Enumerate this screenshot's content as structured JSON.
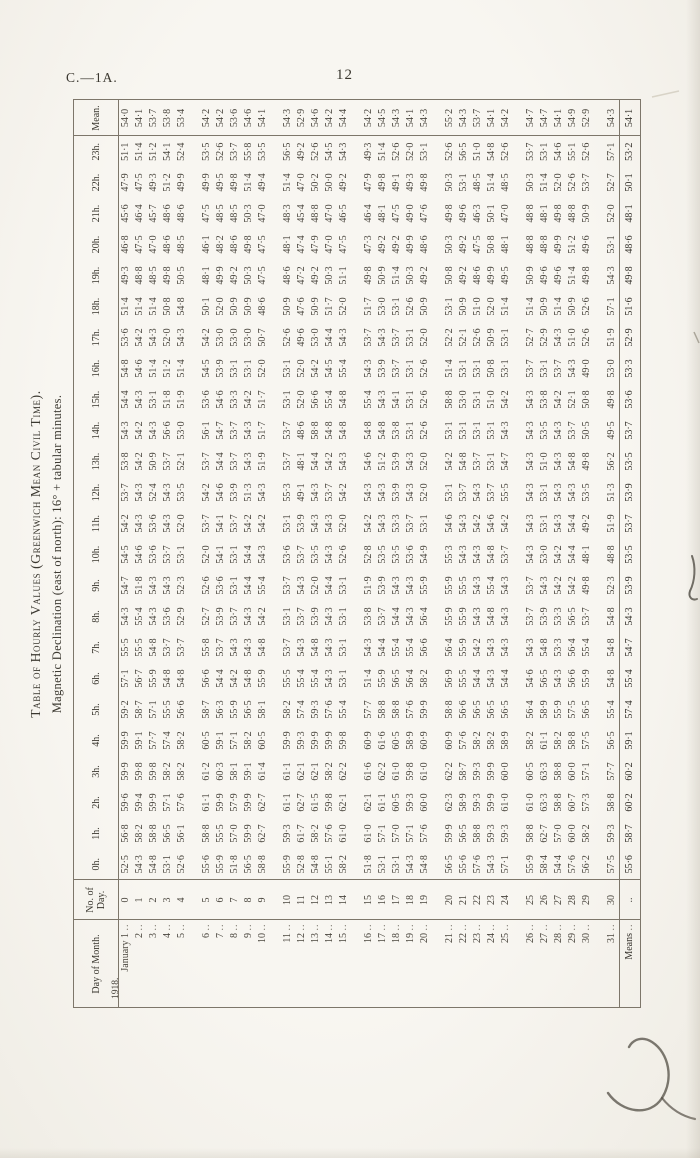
{
  "page": {
    "doc_ref": "C.—1A.",
    "page_number": "12"
  },
  "table": {
    "title": "Table of Hourly Values (Greenwich Mean Civil Time).",
    "subtitle": "Magnetic Declination (east of north): 16° + tabular minutes.",
    "year_label": "1918.",
    "means_label": "Means",
    "leader_dots": "..",
    "columns": [
      "Day of Month.",
      "No. of Day.",
      "0h.",
      "1h.",
      "2h.",
      "3h.",
      "4h.",
      "5h.",
      "6h.",
      "7h.",
      "8h.",
      "9h.",
      "10h.",
      "11h.",
      "12h.",
      "13h.",
      "14h.",
      "15h.",
      "16h.",
      "17h.",
      "18h.",
      "19h.",
      "20h.",
      "21h.",
      "22h.",
      "23h.",
      "Mean."
    ],
    "day_labels": [
      "January 1",
      "2",
      "3",
      "4",
      "5",
      "6",
      "7",
      "8",
      "9",
      "10",
      "11",
      "12",
      "13",
      "14",
      "15",
      "16",
      "17",
      "18",
      "19",
      "20",
      "21",
      "22",
      "23",
      "24",
      "25",
      "26",
      "27",
      "28",
      "29",
      "30",
      "31"
    ],
    "no_of_day": [
      "0",
      "1",
      "2",
      "3",
      "4",
      "5",
      "6",
      "7",
      "8",
      "9",
      "10",
      "11",
      "12",
      "13",
      "14",
      "15",
      "16",
      "17",
      "18",
      "19",
      "20",
      "21",
      "22",
      "23",
      "24",
      "25",
      "26",
      "27",
      "28",
      "29",
      "30"
    ],
    "hours": [
      {
        "label": "0h.",
        "values": [
          "52·5",
          "54·3",
          "54·8",
          "53·1",
          "52·6",
          "55·6",
          "55·9",
          "51·8",
          "56·5",
          "58·8",
          "55·9",
          "52·8",
          "54·8",
          "55·1",
          "58·2",
          "51·8",
          "53·1",
          "53·1",
          "54·3",
          "54·8",
          "56·5",
          "55·6",
          "57·6",
          "54·3",
          "57·1",
          "55·9",
          "58·4",
          "54·4",
          "57·6",
          "56·2",
          "57·5",
          "55·6"
        ]
      },
      {
        "label": "1h.",
        "values": [
          "56·8",
          "58·2",
          "58·8",
          "56·5",
          "56·1",
          "58·8",
          "55·5",
          "57·0",
          "59·9",
          "62·7",
          "59·3",
          "61·7",
          "58·2",
          "57·6",
          "61·0",
          "61·0",
          "57·1",
          "57·0",
          "57·1",
          "57·6",
          "59·9",
          "56·5",
          "58·8",
          "59·3",
          "59·3",
          "58·8",
          "62·7",
          "57·0",
          "60·0",
          "58·2",
          "59·3",
          "58·7"
        ]
      },
      {
        "label": "2h.",
        "values": [
          "59·6",
          "59·4",
          "59·9",
          "57·1",
          "57·6",
          "61·1",
          "59·9",
          "57·9",
          "59·9",
          "62·7",
          "61·1",
          "62·7",
          "61·5",
          "59·8",
          "62·1",
          "62·1",
          "61·1",
          "60·5",
          "59·3",
          "60·0",
          "62·3",
          "58·9",
          "59·3",
          "59·9",
          "61·0",
          "61·0",
          "63·3",
          "58·8",
          "60·7",
          "57·3",
          "58·8",
          "60·2"
        ]
      },
      {
        "label": "3h.",
        "values": [
          "59·9",
          "59·8",
          "59·8",
          "58·2",
          "58·2",
          "61·2",
          "60·3",
          "58·1",
          "59·1",
          "61·4",
          "61·1",
          "62·1",
          "62·1",
          "58·2",
          "62·2",
          "61·6",
          "62·2",
          "61·0",
          "59·8",
          "61·0",
          "62·2",
          "58·7",
          "59·3",
          "59·9",
          "60·0",
          "60·5",
          "63·3",
          "58·8",
          "60·0",
          "57·1",
          "57·7",
          "60·2"
        ]
      },
      {
        "label": "4h.",
        "values": [
          "59·9",
          "59·1",
          "57·7",
          "57·4",
          "58·2",
          "60·5",
          "59·1",
          "57·1",
          "58·2",
          "60·5",
          "59·9",
          "59·3",
          "59·9",
          "59·9",
          "59·8",
          "60·9",
          "61·6",
          "60·5",
          "58·9",
          "60·9",
          "60·9",
          "57·6",
          "58·2",
          "58·2",
          "58·9",
          "58·2",
          "61·1",
          "58·2",
          "58·8",
          "57·5",
          "56·5",
          "59·1"
        ]
      },
      {
        "label": "5h.",
        "values": [
          "59·2",
          "58·7",
          "57·1",
          "55·5",
          "56·6",
          "58·7",
          "56·3",
          "55·9",
          "56·5",
          "58·1",
          "58·2",
          "57·4",
          "59·3",
          "57·6",
          "55·4",
          "57·7",
          "58·8",
          "58·8",
          "57·6",
          "59·9",
          "58·8",
          "56·6",
          "56·5",
          "56·5",
          "56·5",
          "56·4",
          "58·9",
          "55·9",
          "57·5",
          "56·5",
          "55·4",
          "57·4"
        ]
      },
      {
        "label": "6h.",
        "values": [
          "57·1",
          "56·7",
          "55·9",
          "54·8",
          "54·8",
          "56·6",
          "54·4",
          "54·2",
          "54·8",
          "55·9",
          "55·5",
          "55·4",
          "55·4",
          "54·3",
          "53·1",
          "51·4",
          "55·9",
          "56·5",
          "56·4",
          "58·2",
          "56·9",
          "55·5",
          "54·4",
          "54·3",
          "54·4",
          "54·6",
          "56·5",
          "54·3",
          "56·6",
          "55·9",
          "54·8",
          "55·4"
        ]
      },
      {
        "label": "7h.",
        "values": [
          "55·5",
          "55·5",
          "54·8",
          "53·7",
          "53·7",
          "55·8",
          "53·7",
          "54·3",
          "54·3",
          "54·8",
          "53·7",
          "54·3",
          "54·8",
          "54·3",
          "53·1",
          "54·3",
          "54·4",
          "55·4",
          "55·4",
          "56·6",
          "56·4",
          "55·9",
          "54·2",
          "54·3",
          "54·3",
          "54·3",
          "54·8",
          "53·3",
          "56·4",
          "55·4",
          "54·8",
          "54·7"
        ]
      },
      {
        "label": "8h.",
        "values": [
          "54·3",
          "55·4",
          "54·3",
          "53·6",
          "52·9",
          "52·7",
          "53·9",
          "53·7",
          "54·3",
          "54·2",
          "53·1",
          "53·7",
          "53·9",
          "54·3",
          "53·1",
          "53·8",
          "53·7",
          "54·4",
          "54·3",
          "56·4",
          "55·9",
          "55·9",
          "54·3",
          "54·8",
          "54·3",
          "53·7",
          "53·9",
          "53·3",
          "56·5",
          "53·7",
          "54·8",
          "54·3"
        ]
      },
      {
        "label": "9h.",
        "values": [
          "54·7",
          "51·8",
          "54·3",
          "54·3",
          "52·3",
          "52·6",
          "53·6",
          "53·1",
          "54·4",
          "55·4",
          "53·7",
          "54·3",
          "52·0",
          "54·4",
          "53·1",
          "51·9",
          "53·9",
          "54·3",
          "54·3",
          "55·9",
          "55·9",
          "55·5",
          "54·3",
          "55·4",
          "54·3",
          "53·7",
          "54·3",
          "54·2",
          "54·2",
          "49·8",
          "52·3",
          "53·9"
        ]
      },
      {
        "label": "10h.",
        "values": [
          "54·5",
          "54·6",
          "53·6",
          "53·7",
          "53·1",
          "52·0",
          "54·1",
          "53·1",
          "54·4",
          "54·3",
          "53·6",
          "53·7",
          "53·5",
          "54·3",
          "52·6",
          "52·8",
          "53·5",
          "53·5",
          "53·6",
          "54·9",
          "55·3",
          "54·3",
          "54·3",
          "54·8",
          "53·7",
          "54·3",
          "53·0",
          "54·2",
          "54·4",
          "48·1",
          "48·8",
          "53·5"
        ]
      },
      {
        "label": "11h.",
        "values": [
          "54·2",
          "54·3",
          "53·6",
          "54·3",
          "52·0",
          "53·7",
          "54·1",
          "53·7",
          "54·2",
          "54·2",
          "53·1",
          "53·9",
          "54·3",
          "54·3",
          "52·0",
          "54·2",
          "54·3",
          "53·3",
          "53·7",
          "53·1",
          "54·6",
          "54·3",
          "54·2",
          "54·6",
          "54·2",
          "54·3",
          "53·1",
          "54·3",
          "54·4",
          "49·2",
          "51·9",
          "53·7"
        ]
      },
      {
        "label": "12h.",
        "values": [
          "53·7",
          "54·3",
          "52·4",
          "54·3",
          "53·5",
          "54·2",
          "54·6",
          "53·9",
          "51·3",
          "54·3",
          "55·3",
          "49·1",
          "54·3",
          "53·7",
          "54·2",
          "54·3",
          "54·3",
          "53·9",
          "54·3",
          "52·0",
          "53·1",
          "53·7",
          "54·3",
          "53·7",
          "55·5",
          "54·3",
          "53·1",
          "54·3",
          "54·3",
          "53·5",
          "51·3",
          "53·9"
        ]
      },
      {
        "label": "13h.",
        "values": [
          "53·8",
          "54·2",
          "50·9",
          "53·7",
          "52·1",
          "53·7",
          "54·4",
          "53·7",
          "54·3",
          "51·9",
          "53·7",
          "48·1",
          "54·4",
          "54·2",
          "54·3",
          "54·6",
          "51·2",
          "53·9",
          "54·3",
          "52·0",
          "54·2",
          "54·8",
          "53·7",
          "53·1",
          "54·7",
          "54·3",
          "51·0",
          "54·3",
          "54·8",
          "49·8",
          "56·2",
          "53·5"
        ]
      },
      {
        "label": "14h.",
        "values": [
          "54·3",
          "54·2",
          "54·3",
          "56·6",
          "53·0",
          "56·1",
          "54·7",
          "53·7",
          "54·3",
          "51·7",
          "53·7",
          "48·6",
          "58·8",
          "54·8",
          "54·8",
          "54·8",
          "54·8",
          "53·8",
          "53·1",
          "52·6",
          "53·1",
          "53·1",
          "53·1",
          "53·1",
          "54·3",
          "54·3",
          "53·5",
          "54·3",
          "53·7",
          "50·5",
          "49·5",
          "53·7"
        ]
      },
      {
        "label": "15h.",
        "values": [
          "54·4",
          "54·3",
          "53·1",
          "51·8",
          "51·9",
          "53·6",
          "54·6",
          "53·3",
          "54·2",
          "51·7",
          "53·1",
          "52·0",
          "56·6",
          "55·4",
          "54·8",
          "55·4",
          "54·3",
          "54·1",
          "53·1",
          "52·6",
          "58·8",
          "53·0",
          "53·1",
          "51·0",
          "54·2",
          "54·3",
          "53·8",
          "54·2",
          "52·1",
          "50·8",
          "49·8",
          "53·6"
        ]
      },
      {
        "label": "16h.",
        "values": [
          "54·8",
          "54·6",
          "51·4",
          "51·2",
          "51·4",
          "54·5",
          "53·9",
          "53·1",
          "53·1",
          "52·0",
          "53·1",
          "52·0",
          "54·2",
          "54·5",
          "55·4",
          "54·3",
          "53·9",
          "53·7",
          "53·1",
          "52·6",
          "51·4",
          "53·1",
          "53·1",
          "50·8",
          "53·1",
          "53·7",
          "53·1",
          "53·7",
          "54·3",
          "49·0",
          "53·0",
          "53·3"
        ]
      },
      {
        "label": "17h.",
        "values": [
          "53·6",
          "54·2",
          "54·3",
          "52·0",
          "54·3",
          "54·2",
          "53·0",
          "53·0",
          "53·0",
          "50·7",
          "52·6",
          "49·6",
          "53·0",
          "54·4",
          "54·3",
          "53·7",
          "54·3",
          "53·7",
          "53·1",
          "52·0",
          "52·2",
          "52·1",
          "52·6",
          "50·9",
          "53·1",
          "52·7",
          "52·9",
          "54·3",
          "51·0",
          "52·6",
          "51·9",
          "52·9"
        ]
      },
      {
        "label": "18h.",
        "values": [
          "51·4",
          "51·4",
          "51·4",
          "50·8",
          "54·8",
          "50·1",
          "52·0",
          "50·9",
          "50·9",
          "48·6",
          "50·9",
          "47·6",
          "50·9",
          "51·7",
          "52·0",
          "51·7",
          "53·0",
          "53·1",
          "52·6",
          "50·9",
          "53·1",
          "50·9",
          "51·0",
          "52·0",
          "51·4",
          "51·4",
          "50·9",
          "51·4",
          "50·9",
          "52·6",
          "57·1",
          "51·6"
        ]
      },
      {
        "label": "19h.",
        "values": [
          "49·3",
          "48·8",
          "48·5",
          "49·8",
          "50·5",
          "48·1",
          "49·9",
          "49·2",
          "50·3",
          "47·5",
          "48·6",
          "47·2",
          "49·2",
          "50·3",
          "51·1",
          "49·8",
          "50·9",
          "51·4",
          "50·3",
          "49·2",
          "50·8",
          "49·2",
          "48·6",
          "49·9",
          "49·5",
          "50·9",
          "49·6",
          "49·6",
          "51·4",
          "49·8",
          "54·3",
          "49·8"
        ]
      },
      {
        "label": "20h.",
        "values": [
          "46·8",
          "47·5",
          "47·0",
          "48·6",
          "48·5",
          "46·1",
          "48·2",
          "48·6",
          "49·8",
          "47·5",
          "48·1",
          "47·4",
          "47·9",
          "47·0",
          "47·5",
          "47·3",
          "49·2",
          "49·2",
          "49·9",
          "48·6",
          "50·3",
          "49·2",
          "47·5",
          "50·8",
          "48·1",
          "48·8",
          "48·8",
          "49·9",
          "51·2",
          "49·6",
          "53·1",
          "48·6"
        ]
      },
      {
        "label": "21h.",
        "values": [
          "45·6",
          "46·4",
          "45·7",
          "48·6",
          "48·6",
          "47·5",
          "48·5",
          "48·5",
          "50·3",
          "47·0",
          "48·3",
          "45·4",
          "48·8",
          "47·0",
          "46·5",
          "46·4",
          "48·1",
          "47·5",
          "49·0",
          "47·6",
          "49·8",
          "49·6",
          "46·3",
          "50·1",
          "47·0",
          "48·8",
          "48·1",
          "49·8",
          "48·8",
          "50·9",
          "52·0",
          "48·1"
        ]
      },
      {
        "label": "22h.",
        "values": [
          "47·9",
          "47·5",
          "49·3",
          "51·2",
          "49·9",
          "49·9",
          "49·5",
          "49·8",
          "51·4",
          "49·4",
          "51·4",
          "47·0",
          "50·2",
          "50·0",
          "49·2",
          "47·9",
          "49·8",
          "49·1",
          "49·3",
          "49·8",
          "50·3",
          "53·1",
          "48·5",
          "51·4",
          "48·5",
          "50·3",
          "51·4",
          "52·0",
          "52·6",
          "53·7",
          "52·7",
          "50·1"
        ]
      },
      {
        "label": "23h.",
        "values": [
          "51·1",
          "51·4",
          "51·2",
          "54·1",
          "52·4",
          "53·5",
          "52·6",
          "53·7",
          "55·8",
          "53·5",
          "56·5",
          "49·2",
          "52·6",
          "54·5",
          "54·3",
          "49·3",
          "51·4",
          "52·6",
          "52·0",
          "53·1",
          "52·6",
          "56·5",
          "51·0",
          "54·8",
          "52·6",
          "53·7",
          "53·1",
          "54·6",
          "55·1",
          "52·6",
          "57·1",
          "53·2"
        ]
      },
      {
        "label": "Mean.",
        "values": [
          "54·0",
          "54·1",
          "53·7",
          "53·8",
          "53·4",
          "54·2",
          "54·2",
          "53·6",
          "54·6",
          "54·1",
          "54·3",
          "52·9",
          "54·6",
          "54·2",
          "54·4",
          "54·2",
          "54·5",
          "54·3",
          "54·1",
          "54·3",
          "55·2",
          "54·3",
          "53·7",
          "54·1",
          "54·2",
          "54·7",
          "54·7",
          "54·1",
          "54·9",
          "52·9",
          "54·3",
          "54·1"
        ]
      }
    ]
  }
}
